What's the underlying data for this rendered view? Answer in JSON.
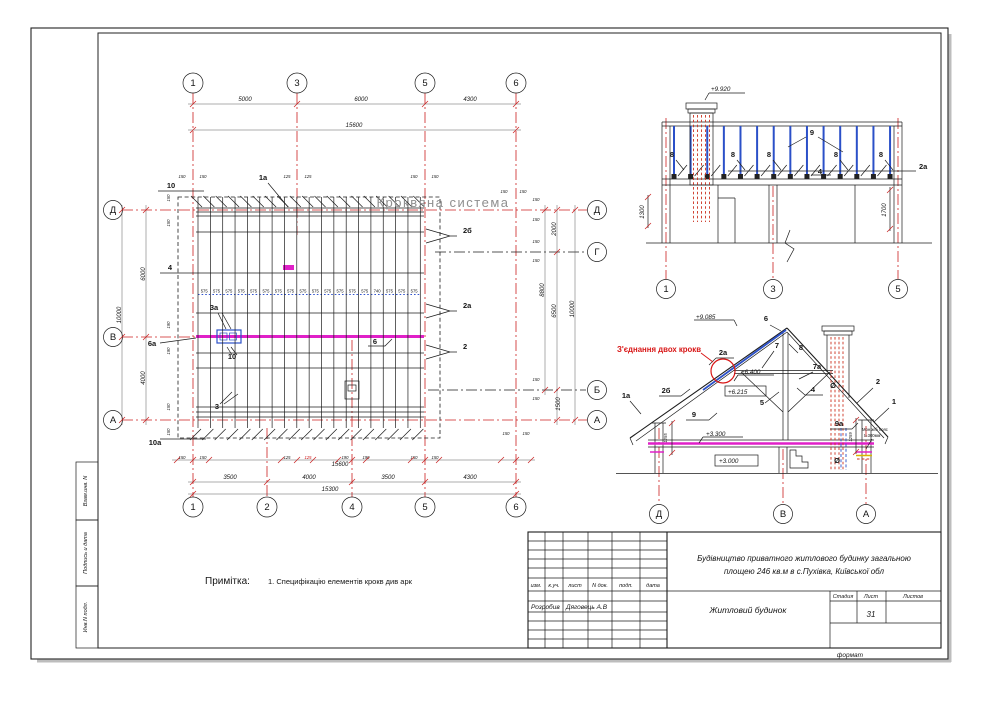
{
  "sheet": {
    "stamps": [
      "Взам.инв. N",
      "Подпись и дата",
      "Инв.N подл."
    ],
    "format_label": "формат"
  },
  "note": {
    "label": "Примітка:",
    "text": "1. Специфікацію елементів крокв див арк"
  },
  "plan": {
    "title": "Кроквяна система",
    "axes_top": [
      "1",
      "3",
      "5",
      "6"
    ],
    "axes_bottom": [
      "1",
      "2",
      "4",
      "5",
      "6"
    ],
    "axes_left": [
      "Д",
      "В",
      "А"
    ],
    "axes_right": [
      "Д",
      "Г",
      "Б",
      "А"
    ],
    "dims_top": [
      "5000",
      "6000",
      "4300"
    ],
    "dims_bottom": [
      "3500",
      "4000",
      "3500",
      "4300"
    ],
    "dims_left": [
      "6000",
      "4000"
    ],
    "dims_right": [
      "2000",
      "6500",
      "1500"
    ],
    "totals": {
      "top": "15600",
      "bottom": "15300",
      "bottom_sub": "15600",
      "left": "10000",
      "right": "10000",
      "right_span": "8800"
    },
    "small_top": [
      "150",
      "150",
      "125",
      "125",
      "150",
      "150",
      "150",
      "150"
    ],
    "small_bottom": [
      "150",
      "150",
      "125",
      "125",
      "190",
      "190",
      "150",
      "150",
      "150",
      "150"
    ],
    "small_left": [
      "150",
      "150",
      "190",
      "190",
      "150",
      "150"
    ],
    "small_right": [
      "150",
      "150",
      "150",
      "150",
      "150",
      "150"
    ],
    "spacing_labels": [
      "575",
      "575",
      "575",
      "575",
      "575",
      "575",
      "575",
      "575",
      "575",
      "575",
      "575",
      "575",
      "575",
      "575",
      "740",
      "575",
      "575",
      "575"
    ],
    "callouts": [
      "10",
      "1а",
      "2б",
      "4",
      "3а",
      "6а",
      "10",
      "6",
      "3",
      "10а",
      "2а",
      "2"
    ]
  },
  "elevation": {
    "level_top": "+9.920",
    "label_9": "9",
    "label_2a": "2а",
    "label_4": "4",
    "eights": [
      "8",
      "8",
      "8",
      "8",
      "8"
    ],
    "dim_left": "1300",
    "dim_right": "1700",
    "axes": [
      "1",
      "3",
      "5"
    ]
  },
  "section": {
    "levels": {
      "ridge": "+9.085",
      "collar_top": "+6.400",
      "collar_bottom": "+6.215",
      "slab_top": "+3.300",
      "floor": "+3.000"
    },
    "annotation": "З'єднання двох крокв",
    "belt_note_line1": "Мон.ж/б пояс",
    "belt_note_line2": "t=300мм",
    "callouts": [
      "6",
      "7",
      "8",
      "7а",
      "2а",
      "2б",
      "1а",
      "9",
      "5",
      "4",
      "2",
      "1",
      "9а",
      "Ø",
      "Ø"
    ],
    "dims": [
      "1255",
      "1259"
    ],
    "axes": [
      "Д",
      "В",
      "А"
    ]
  },
  "titleblock": {
    "headers": [
      "изм.",
      "к.уч.",
      "лист",
      "N док.",
      "подп.",
      "дата"
    ],
    "role": "Розробив",
    "name": "Дяговець А.В",
    "project_line1": "Будівництво приватного житлового будинку загальною",
    "project_line2": "площею 246 кв.м в с.Пухівка, Київської обл",
    "object_name": "Житловий будинок",
    "stage_label": "Стадия",
    "sheet_label": "Лист",
    "sheets_label": "Листов",
    "sheet_number": "31"
  },
  "colors": {
    "axis_red": "#cc2020",
    "magenta": "#e020c8",
    "blue": "#2b50c8",
    "hatch_red": "#cc3322",
    "gray_title": "#8f8f8f"
  }
}
